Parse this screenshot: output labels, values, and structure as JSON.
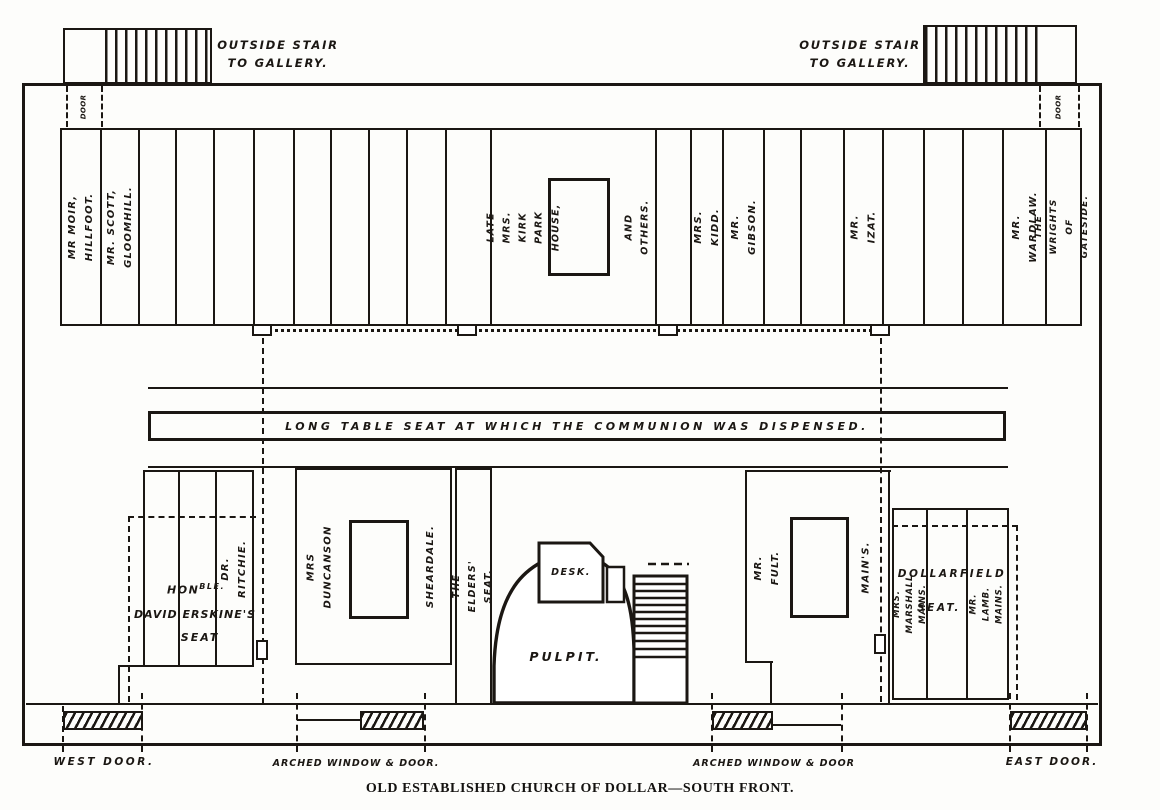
{
  "caption": "OLD ESTABLISHED CHURCH OF DOLLAR—SOUTH FRONT.",
  "outside": {
    "stair_left": "OUTSIDE STAIR\nTO GALLERY.",
    "stair_right": "OUTSIDE STAIR\nTO GALLERY."
  },
  "doors": {
    "top_left": "DOOR",
    "top_right": "DOOR",
    "west": "WEST  DOOR.",
    "arched_left": "ARCHED WINDOW & DOOR.",
    "arched_right": "ARCHED WINDOW & DOOR",
    "east": "EAST  DOOR."
  },
  "gallery": {
    "moir": "MR  MOIR,\nHILLFOOT.",
    "scott": "MR. SCOTT, GLOOMHILL.",
    "kirk": "LATE  MRS. KIRK\nPARK HOUSE,",
    "others": "AND OTHERS.",
    "kidd": "MRS. KIDD.",
    "gibson": "MR. GIBSON.",
    "izat": "MR.  IZAT.",
    "wardlaw": "MR. WARDLAW.",
    "wrights": "THE WRIGHTS\nOF GATESIDE."
  },
  "communion_table": "LONG  TABLE  SEAT  AT  WHICH  THE  COMMUNION  WAS  DISPENSED.",
  "floor": {
    "ritchie": "DR. RITCHIE.",
    "erskine": {
      "hon": "HON",
      "hon_sup": "BLE.",
      "line2": "DAVID  ERSKINE'S",
      "line3": "SEAT"
    },
    "duncanson": "MRS  DUNCANSON",
    "sheardale": "SHEARDALE.",
    "elders": "THE ELDERS' SEAT.",
    "desk": "DESK.",
    "pulpit": "PULPIT.",
    "fult": "MR.  FULT.",
    "mains": "MAIN'S.",
    "marshall": "MRS. MARSHALL MAINS.",
    "dollarfield_line1": "DOLLARFIELD",
    "dollarfield_line2": "SEAT.",
    "lamb": "MR. LAMB. MAINS."
  }
}
